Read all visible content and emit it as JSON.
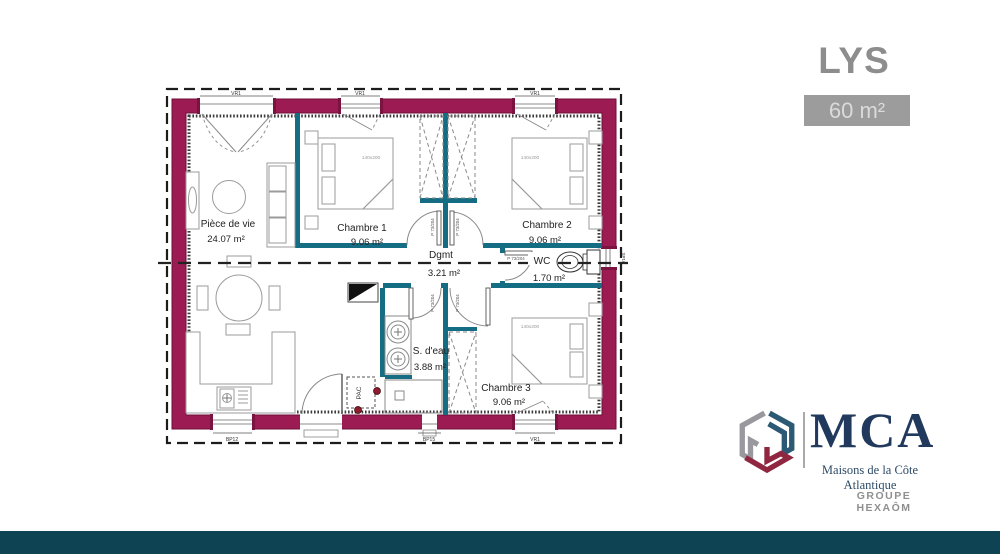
{
  "header": {
    "title": "LYS",
    "area_badge": "60 m²"
  },
  "plan": {
    "rooms": [
      {
        "name": "Pièce de vie",
        "area": "24.07 m²"
      },
      {
        "name": "Chambre 1",
        "area": "9.06 m²"
      },
      {
        "name": "Chambre 2",
        "area": "9.06 m²"
      },
      {
        "name": "Dgmt",
        "area": "3.21 m²"
      },
      {
        "name": "WC",
        "area": "1.70 m²"
      },
      {
        "name": "S. d'eau",
        "area": "3.88 m²"
      },
      {
        "name": "Chambre 3",
        "area": "9.06 m²"
      }
    ],
    "bed_size_label": "140x200",
    "door_label": "P 73/204",
    "fixtures": {
      "pac": "PAC"
    },
    "openings": {
      "top": [
        "VR1",
        "VR1",
        "VR1"
      ],
      "bottom": [
        "BP12",
        "BP15",
        "VR1"
      ],
      "right": [
        "SP10"
      ]
    }
  },
  "branding": {
    "name": "MCA",
    "tagline": "Maisons de la Côte Atlantique",
    "group": "GROUPE HEXAÔM"
  },
  "colors": {
    "exterior_wall": "#9c1b52",
    "interior_wall": "#156d84",
    "footer_bar": "#0e4354",
    "brand_navy": "#21395c",
    "title_gray": "#8d8d8d"
  }
}
